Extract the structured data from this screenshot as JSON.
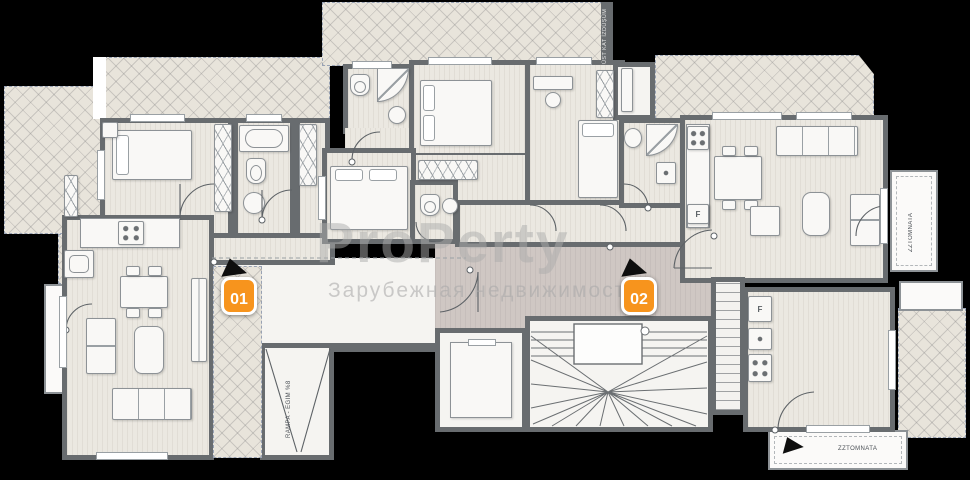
{
  "watermark": {
    "title": "ProPerty",
    "subtitle": "Зарубежная недвижимость"
  },
  "units": [
    {
      "id": "01"
    },
    {
      "id": "02"
    }
  ],
  "annotations": {
    "roof_projection": "ÜST KAT İZDÜŞÜM",
    "ramp": "RAMPA - EĞİM %8",
    "terrace_right": "ZZTOMNATA",
    "balcony_bottom": "ZZTOMNATA",
    "fridge": "F"
  },
  "colors": {
    "badge": "#f7941d",
    "walls": "#686c6f",
    "room_fill": "#ebe8e1",
    "hall_fill": "#cfc7c3",
    "hatch_fill": "#e8e4db",
    "background": "#000000"
  }
}
